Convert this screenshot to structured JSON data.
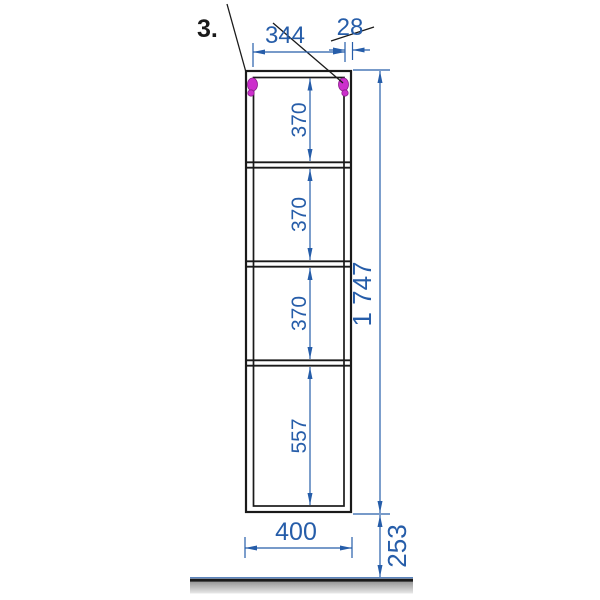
{
  "colors": {
    "dim-blue": "#265da9",
    "line-black": "#1a1a1a",
    "hinge-magenta": "#cc2fcc",
    "floor-gray-dark": "#969696",
    "floor-gray-light": "#e9e9e9"
  },
  "drawing": {
    "callout_label": "3.",
    "dims": {
      "inner_width": "344",
      "panel_thickness": "28",
      "shelf_gap_1": "370",
      "shelf_gap_2": "370",
      "shelf_gap_3": "370",
      "bottom_gap": "557",
      "total_height": "1 747",
      "outer_width": "400",
      "floor_offset": "253"
    }
  }
}
